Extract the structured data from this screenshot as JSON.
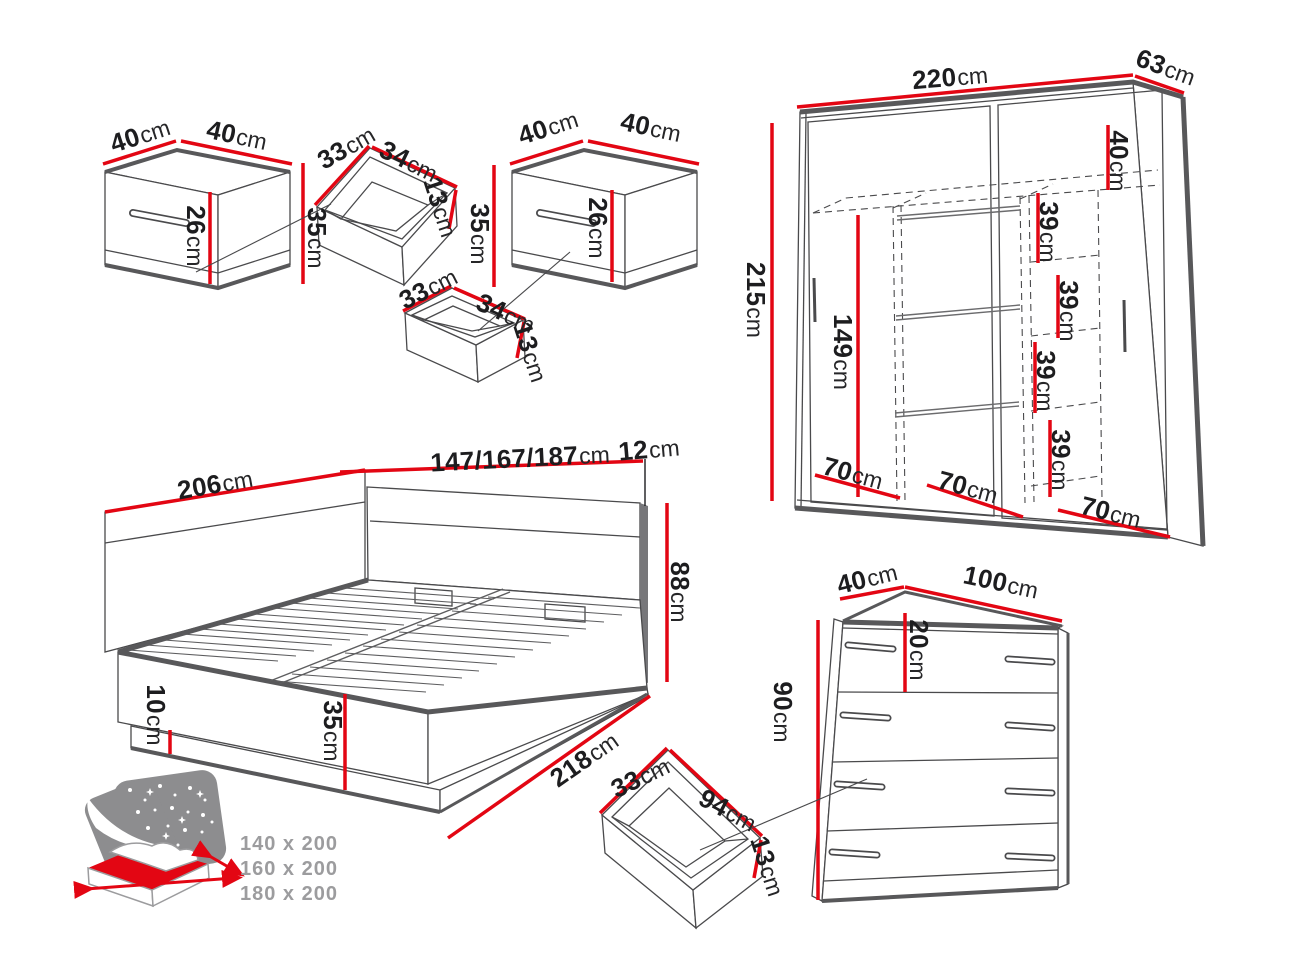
{
  "unit": "cm",
  "dims": {
    "nightstand": {
      "w": "40",
      "d": "40",
      "h": "35",
      "front": "26"
    },
    "small_drawer": {
      "w": "33",
      "d": "34",
      "h": "13"
    },
    "wardrobe": {
      "w": "220",
      "d": "63",
      "h": "215",
      "inner_h": "149",
      "top_gap": "40",
      "shelf_gap": "39",
      "section": "70"
    },
    "bed": {
      "panel": "206",
      "widths": "147/167/187",
      "hb_thickness": "12",
      "hb_height": "88",
      "length": "218",
      "frame_h": "35",
      "plinth": "10"
    },
    "chest": {
      "d": "40",
      "w": "100",
      "h": "90",
      "drawer_front": "20"
    },
    "large_drawer": {
      "w": "33",
      "d": "94",
      "h": "13"
    }
  },
  "mattress_sizes": [
    "140 x 200",
    "160 x 200",
    "180 x 200"
  ],
  "colors": {
    "accent_red": "#e30613",
    "line_gray": "#4a4a4c",
    "thick_gray": "#58585a",
    "icon_gray": "#9c9c9e"
  }
}
